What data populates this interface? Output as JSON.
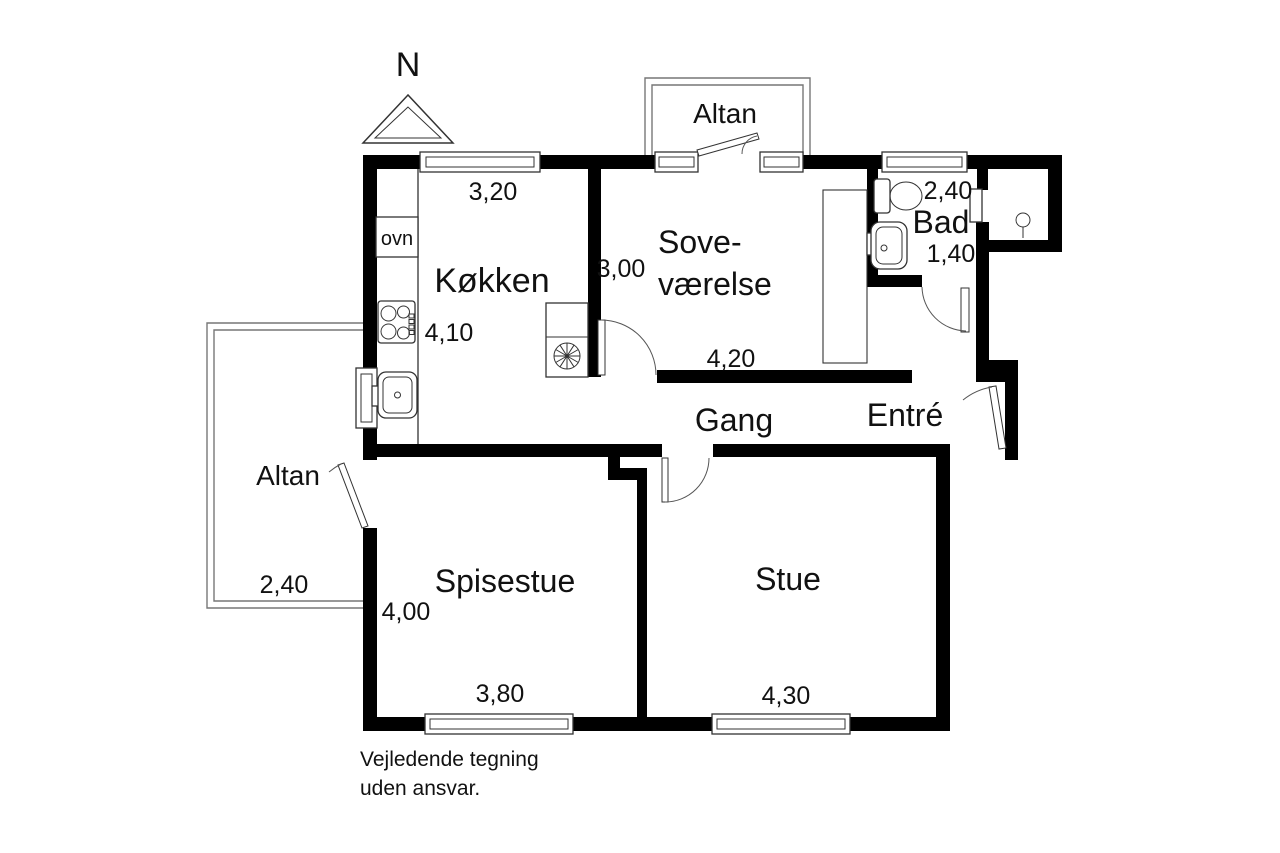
{
  "floor_plan": {
    "north_label": "N",
    "rooms": {
      "kitchen": "Køkken",
      "bedroom_line1": "Sove-",
      "bedroom_line2": "værelse",
      "bathroom": "Bad",
      "hallway": "Gang",
      "entry": "Entré",
      "dining": "Spisestue",
      "living": "Stue"
    },
    "balconies": {
      "top": "Altan",
      "left": "Altan"
    },
    "fixtures": {
      "oven": "ovn"
    },
    "dimensions": {
      "kitchen_top": "3,20",
      "bedroom_left": "3,00",
      "kitchen_inner": "4,10",
      "bedroom_bottom": "4,20",
      "bathroom_top": "2,40",
      "bathroom_mid": "1,40",
      "balcony_left": "2,40",
      "dining_left": "4,00",
      "dining_bottom": "3,80",
      "living_bottom": "4,30"
    },
    "disclaimer": {
      "line1": "Vejledende tegning",
      "line2": "uden ansvar."
    },
    "colors": {
      "wall": "#000000",
      "thin_line": "#333333",
      "balcony_line": "#777777",
      "background": "#ffffff"
    }
  }
}
